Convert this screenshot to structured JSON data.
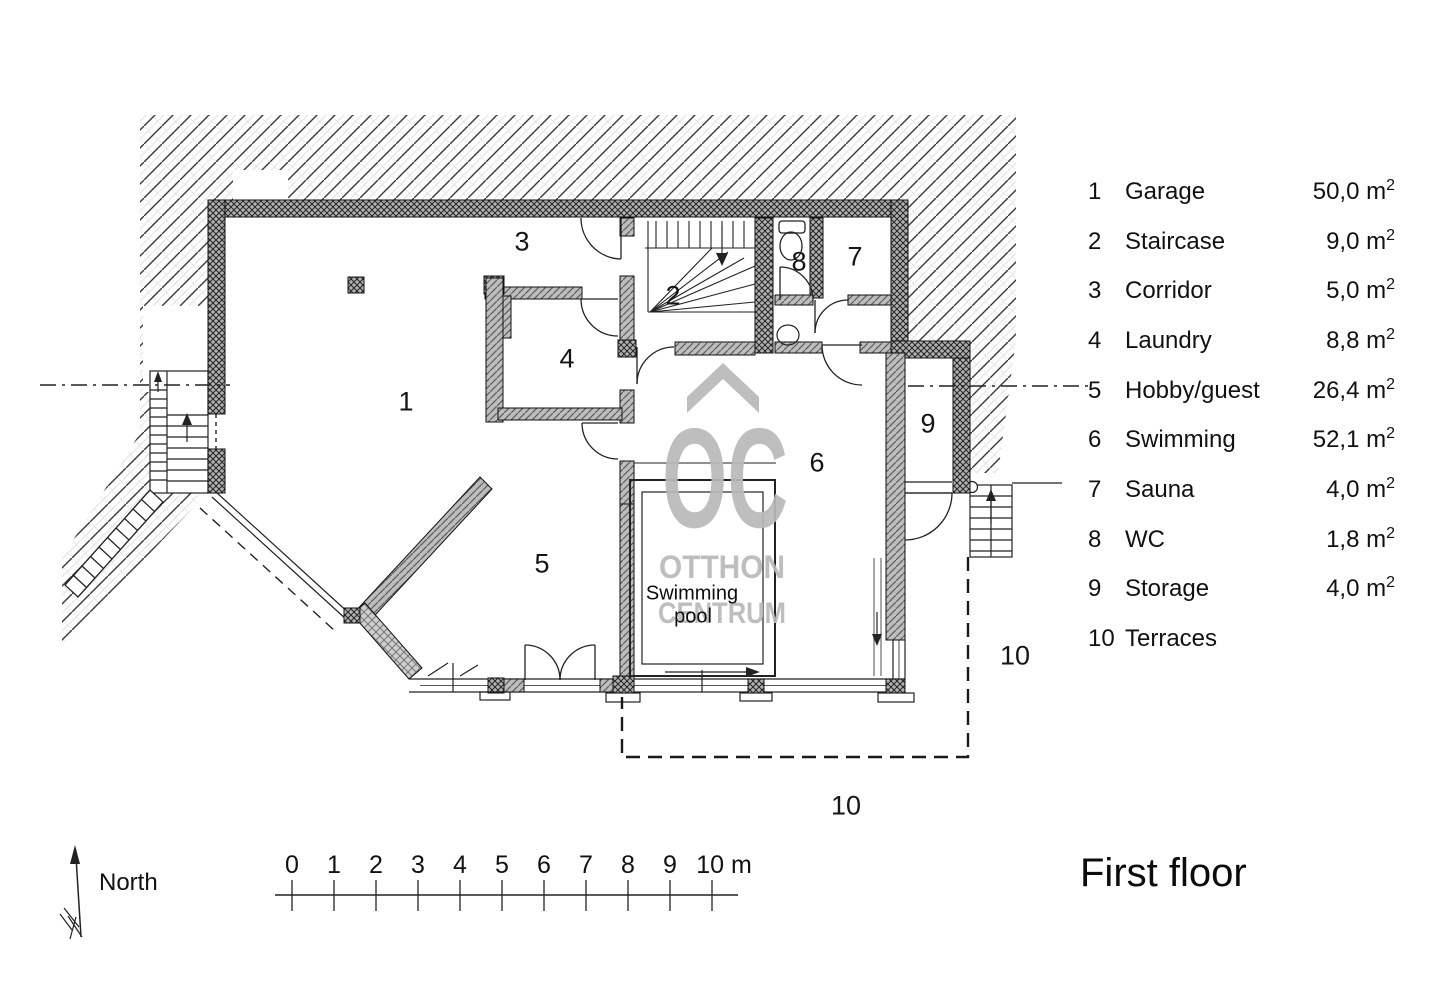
{
  "title": "First floor",
  "compass": {
    "label": "North"
  },
  "watermark": {
    "monogram": "OC",
    "line1": "OTTHON",
    "line2": "CENTRUM",
    "color": "#b9b9b9"
  },
  "plan": {
    "rooms": [
      "1",
      "2",
      "3",
      "4",
      "5",
      "6",
      "7",
      "8",
      "9"
    ],
    "terrace_labels": [
      "10",
      "10"
    ],
    "pool": {
      "line1": "Swimming",
      "line2": "pool"
    }
  },
  "legend": {
    "rows": [
      {
        "num": "1",
        "label": "Garage",
        "area": "50,0 m",
        "sup": "2"
      },
      {
        "num": "2",
        "label": "Staircase",
        "area": "9,0 m",
        "sup": "2"
      },
      {
        "num": "3",
        "label": "Corridor",
        "area": "5,0 m",
        "sup": "2"
      },
      {
        "num": "4",
        "label": "Laundry",
        "area": "8,8 m",
        "sup": "2"
      },
      {
        "num": "5",
        "label": "Hobby/guest",
        "area": "26,4 m",
        "sup": "2"
      },
      {
        "num": "6",
        "label": "Swimming",
        "area": "52,1 m",
        "sup": "2"
      },
      {
        "num": "7",
        "label": "Sauna",
        "area": "4,0 m",
        "sup": "2"
      },
      {
        "num": "8",
        "label": "WC",
        "area": "1,8 m",
        "sup": "2"
      },
      {
        "num": "9",
        "label": "Storage",
        "area": "4,0 m",
        "sup": "2"
      },
      {
        "num": "10",
        "label": "Terraces",
        "area": "",
        "sup": ""
      }
    ]
  },
  "scale_bar": {
    "labels": [
      "0",
      "1",
      "2",
      "3",
      "4",
      "5",
      "6",
      "7",
      "8",
      "9",
      "10 m"
    ]
  }
}
